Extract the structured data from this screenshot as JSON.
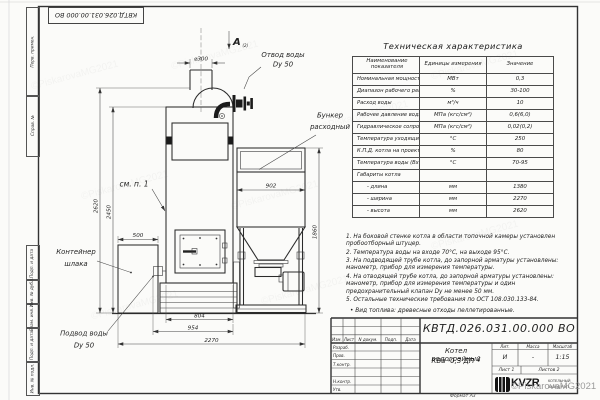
{
  "sheet": {
    "doc_number": "КВТД.026.031.00.000  ВО",
    "doc_number_small": "КВТД.026.031.00.000 ВО",
    "format_label": "Формат А3",
    "watermark": "©PiskarovaMG2021"
  },
  "frame_labels": [
    "Перв. примен.",
    "Справ. №",
    "Подп. и дата",
    "Инв. № дубл.",
    "Взам. инв. №",
    "Подп. и дата",
    "Инв. № подл."
  ],
  "spec_table": {
    "title": "Техническая характеристика",
    "col_name": "Наименование показателя",
    "col_units": "Единицы измерения",
    "col_value": "Значение",
    "rows": [
      {
        "name": "Номинальная мощность",
        "units": "МВт",
        "value": "0,3"
      },
      {
        "name": "Диапазон рабочего регулирования",
        "units": "%",
        "value": "30-100"
      },
      {
        "name": "Расход воды",
        "units": "м³/ч",
        "value": "10"
      },
      {
        "name": "Рабочее давление воды",
        "units": "МПа (кгс/см²)",
        "value": "0,6(6,0)"
      },
      {
        "name": "Гидравлическое сопротивление котла",
        "units": "МПа (кгс/см²)",
        "value": "0,02(0,2)"
      },
      {
        "name": "Температура уходящих газов, не более",
        "units": "°С",
        "value": "250"
      },
      {
        "name": "К.П.Д. котла на проектном топливе",
        "units": "%",
        "value": "80"
      },
      {
        "name": "Температура воды (Вход/выход)",
        "units": "°С",
        "value": "70-95"
      },
      {
        "name": "Габариты котла",
        "units": "",
        "value": ""
      },
      {
        "name": "- длина",
        "units": "мм",
        "value": "1380"
      },
      {
        "name": "- ширина",
        "units": "мм",
        "value": "2270"
      },
      {
        "name": "- высота",
        "units": "мм",
        "value": "2620"
      }
    ]
  },
  "notes": [
    "1. На боковой стенке котла в области топочной камеры установлен пробоотборный штуцер.",
    "2. Температура воды на входе 70°С, на выходе 95°С.",
    "3. На подводящей трубе котла, до запорной арматуры установлены: манометр, прибор для измерения температуры.",
    "4. На отводящей трубе котла, до запорной арматуры установлены: манометр, прибор для измерения температуры и один предохранительный клапан Dу не менее 50 мм.",
    "5. Остальные технические требования по ОСТ 108.030.133-84."
  ],
  "fuel_note": "• Вид топлива: древесные отходы пеллетированные.",
  "drawing": {
    "view_label": "А",
    "view_ref": "(2)",
    "labels": {
      "otvod1": "Отвод воды",
      "otvod2": "Dу 50",
      "bunker1": "Бункер",
      "bunker2": "расходный",
      "see_note": "см. п. 1",
      "container1": "Контейнер",
      "container2": "шлака",
      "podvod1": "Подвод воды",
      "podvod2": "Dу 50"
    },
    "dims": {
      "d300": "⌀300",
      "h2620": "2620",
      "h2450": "2450",
      "h1860": "1860",
      "w500": "500",
      "w902": "902",
      "w804": "804",
      "w954": "954",
      "w2270": "2270"
    }
  },
  "title_block": {
    "change_cols": [
      "Изм.",
      "Лист",
      "N докум.",
      "Подп.",
      "Дата"
    ],
    "roles": [
      "Разраб.",
      "Пров.",
      "Т.контр.",
      "Н.контр.",
      "Утв."
    ],
    "product_name": "Котел водогрейный",
    "product_type": "КВа -0,3 ДП •",
    "lit_label": "Лит.",
    "mass_label": "Масса",
    "scale_label": "Масштаб",
    "lit_value": "И",
    "mass_value": "-",
    "scale_value": "1:15",
    "sheet_info": "Лист 1",
    "sheets_info": "Листов 2",
    "logo": "KVZR",
    "org1": "КОТЕЛЬНЫЙ",
    "org2": "ЗАВОД РЭП"
  }
}
